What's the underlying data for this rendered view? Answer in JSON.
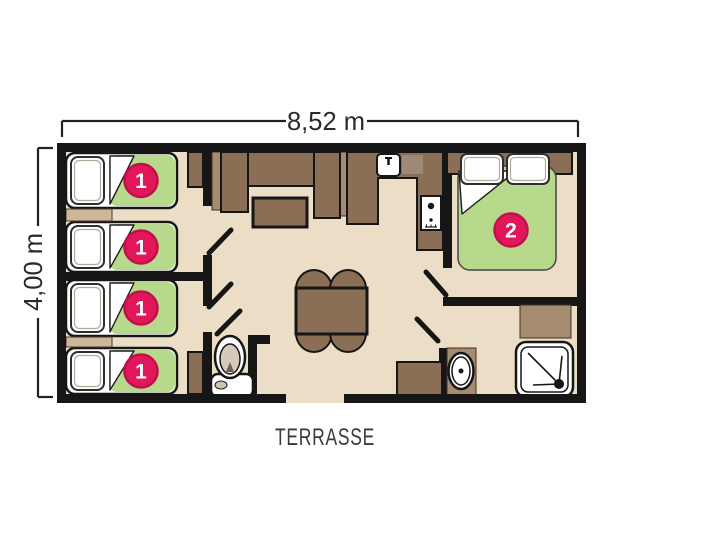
{
  "dimensions": {
    "width_label": "8,52 m",
    "height_label": "4,00 m"
  },
  "labels": {
    "terrace": "TERRASSE"
  },
  "beds": [
    {
      "badge": "1"
    },
    {
      "badge": "1"
    },
    {
      "badge": "1"
    },
    {
      "badge": "1"
    },
    {
      "badge": "2"
    }
  ],
  "colors": {
    "paper": "#ffffff",
    "floor": "#ecdec6",
    "wall": "#161616",
    "furniture": "#8a6f56",
    "furniture_light": "#a58b6f",
    "tan": "#cdb79a",
    "mattress_green": "#b7d98b",
    "badge_pink": "#e2175a",
    "badge_ring": "#c00f4d",
    "text": "#2a2a2a"
  }
}
